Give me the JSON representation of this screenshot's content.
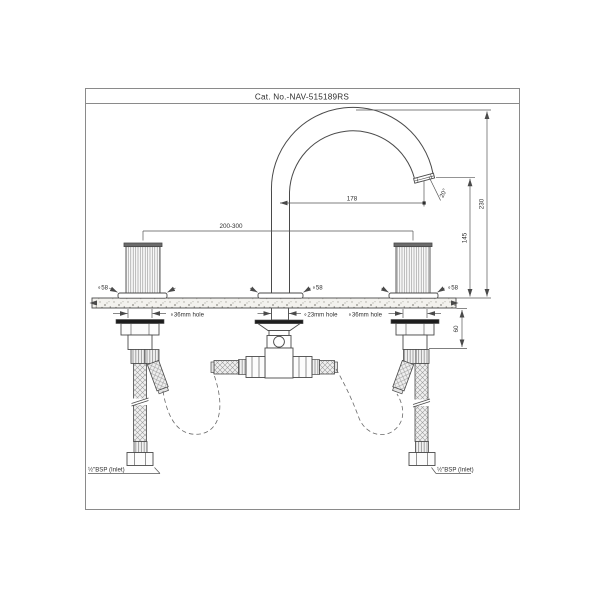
{
  "title": "Cat. No.-NAV-515189RS",
  "dimensions": {
    "spout_reach": "178",
    "overall_height": "230",
    "outlet_height": "145",
    "max_deck": "60",
    "handle_spacing": "200-300",
    "outlet_angle": "20°"
  },
  "labels": {
    "left_handle_dia": "∘58",
    "spout_dia": "∘58",
    "right_handle_dia": "∘58",
    "left_hole": "∘36mm hole",
    "center_hole": "∘23mm hole",
    "right_hole": "∘36mm hole",
    "left_inlet": "½\"BSP (Inlet)",
    "right_inlet": "½\"BSP (Inlet)"
  }
}
